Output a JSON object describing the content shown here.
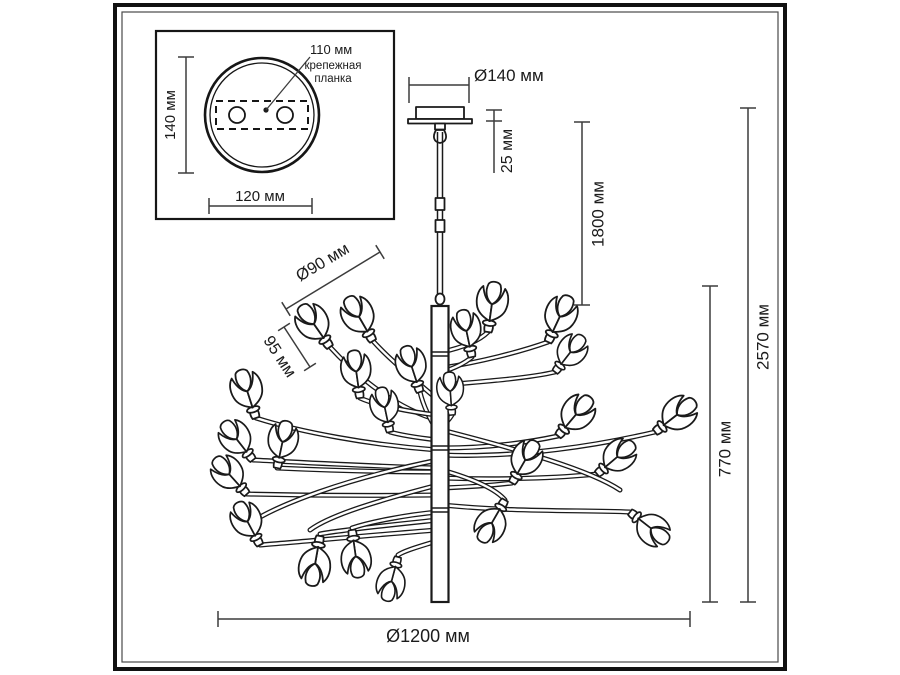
{
  "drawing": {
    "title": "chandelier dimensional drawing",
    "units": "мм",
    "inset": {
      "dim_plate": "110 мм",
      "note_line1": "крепежная",
      "note_line2": "планка",
      "dim_height": "140 мм",
      "dim_width": "120 мм"
    },
    "dims": {
      "canopy_diameter": "Ø140 мм",
      "canopy_height": "25 мм",
      "suspension": "1800 мм",
      "total_height": "2570 мм",
      "body_height": "770 мм",
      "overall_diameter": "Ø1200 мм",
      "shade_diameter": "Ø90 мм",
      "shade_height": "95 мм"
    }
  }
}
